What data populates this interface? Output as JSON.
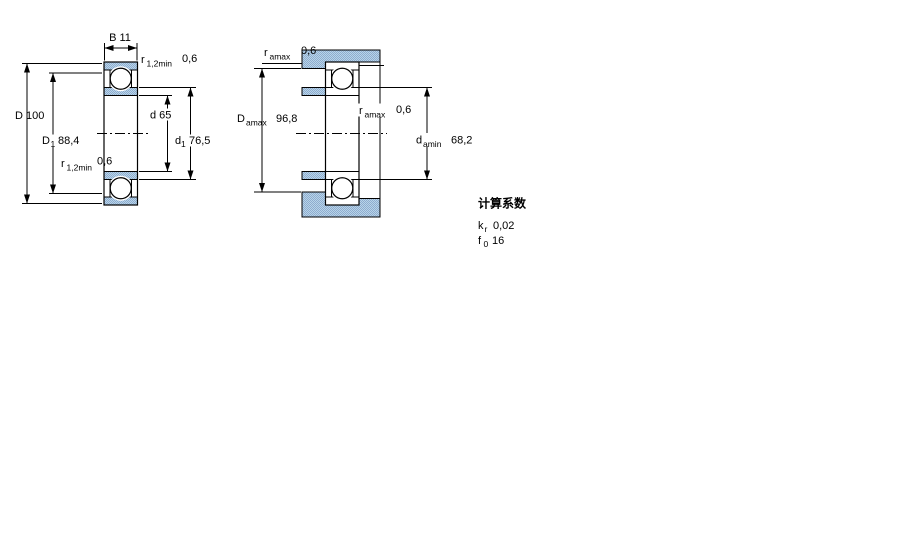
{
  "colors": {
    "hatch_light": "#b7d5e8",
    "hatch_dark": "#8fabcf",
    "line": "#000000",
    "background": "#ffffff"
  },
  "front_view": {
    "width_label": "B 11",
    "outer_diameter_label": "D 100",
    "shoulder_outer": {
      "symbol": "D",
      "sub": "1",
      "value": "88,4"
    },
    "bore_label": "d 65",
    "shoulder_inner": {
      "symbol": "d",
      "sub": "1",
      "value": "76,5"
    },
    "chamfer_top": {
      "symbol": "r",
      "sub": "1,2min",
      "value": "0,6"
    },
    "chamfer_mid": {
      "symbol": "r",
      "sub": "1,2min",
      "value": "0,6"
    }
  },
  "mounting_view": {
    "fillet_top": {
      "symbol": "r",
      "sub": "amax",
      "value": "0,6"
    },
    "fillet_mid": {
      "symbol": "r",
      "sub": "amax",
      "value": "0,6"
    },
    "housing_abutment": {
      "symbol": "D",
      "sub": "amax",
      "value": "96,8"
    },
    "shaft_abutment": {
      "symbol": "d",
      "sub": "amin",
      "value": "68,2"
    }
  },
  "calculation_factors": {
    "title": "计算系数",
    "kr": {
      "symbol": "k",
      "sub": "r",
      "value": "0,02"
    },
    "f0": {
      "symbol": "f",
      "sub": "0",
      "value": "16"
    }
  }
}
